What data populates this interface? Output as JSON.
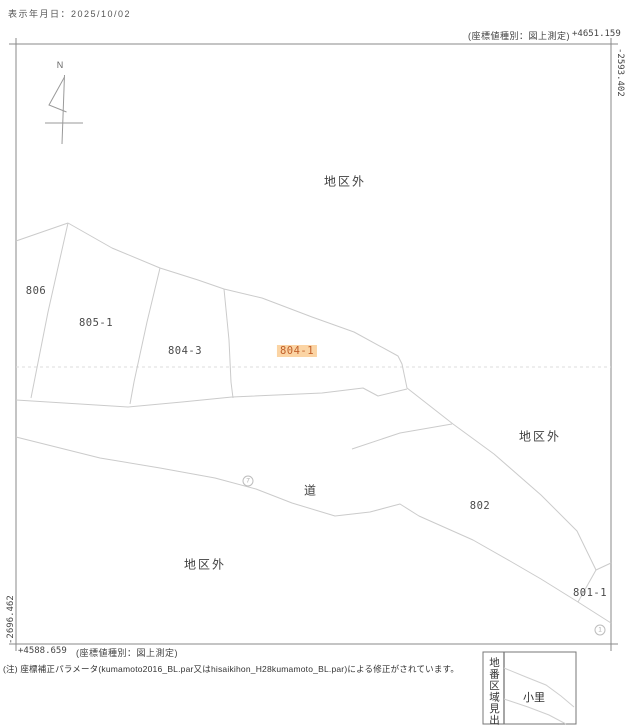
{
  "header": {
    "date": "表示年月日：2025/10/02"
  },
  "coordinates": {
    "top_note": "(座標値種別：図上測定)",
    "top_right_x": "+4651.159",
    "right_y": "-2593.402",
    "bottom_left_x": "+4588.659",
    "bottom_note": "(座標値種別：図上測定)",
    "left_y": "-2696.462"
  },
  "map": {
    "north_label": "N",
    "parcels": [
      {
        "label": "806"
      },
      {
        "label": "805-1"
      },
      {
        "label": "804-3"
      },
      {
        "label": "804-1",
        "highlighted": true
      },
      {
        "label": "802"
      },
      {
        "label": "801-1"
      }
    ],
    "outside_district_label": "地区外",
    "road_label": "道",
    "markers": [
      {
        "label": "7"
      },
      {
        "label": "1"
      }
    ]
  },
  "legend": {
    "title": "地番区域見出",
    "area_name": "小里"
  },
  "footer": {
    "note": "(注) 座標補正パラメータ(kumamoto2016_BL.par又はhisaikihon_H28kumamoto_BL.par)による修正がされています。"
  },
  "colors": {
    "highlight_bg": "#fbd4a4",
    "highlight_text": "#c2602a",
    "parcel_line": "#cbcbcb",
    "frame_line": "#8a8a8a"
  }
}
